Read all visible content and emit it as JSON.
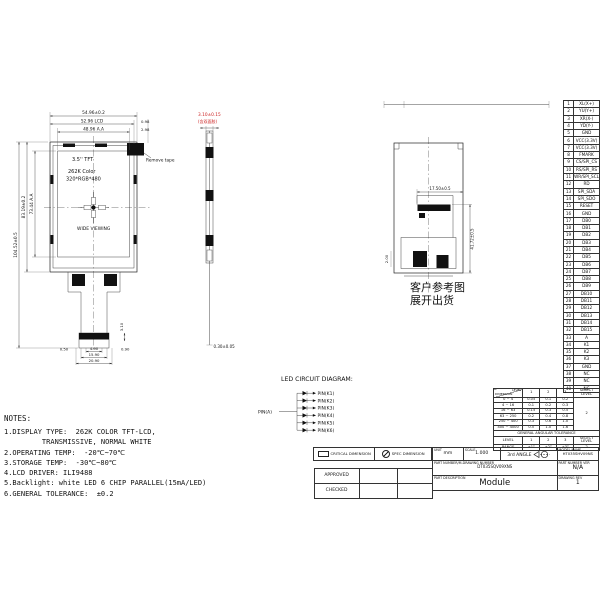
{
  "colors": {
    "line": "#222222",
    "accent_red": "#cc2222"
  },
  "front_view": {
    "panel_labels": [
      "3.5'' TFT",
      "262K Color",
      "320*RGB*480"
    ],
    "viewing_label": "WIDE VIEWING",
    "remove_tape": "Remove tape",
    "dim_width_outline": "54.96±0.2",
    "dim_width_lcd": "52.96 LCD",
    "dim_width_aa": "48.96 A.A",
    "dim_right_1": "0.98",
    "dim_right_2": "2.98",
    "dim_height_total": "104.52±0.5",
    "dim_height_outline": "83.19±0.2",
    "dim_height_aa": "73.44 A.A",
    "dim_fpc_left": "0.50",
    "dim_fpc_w1": "4.90",
    "dim_fpc_w2": "15.90",
    "dim_fpc_w3": "20.90",
    "dim_fpc_right": "0.90",
    "dim_fpc_h": "3.10"
  },
  "side_view": {
    "dim_thickness": "3.10±0.15",
    "dim_thickness_note": "(含双面胶)",
    "dim_fpc_thickness": "0.30±0.05"
  },
  "back_view": {
    "dim_connector": "17.50±0.5",
    "dim_height": "41.72±0.5",
    "dim_small": "2.00",
    "caption_line1": "客户参考图",
    "caption_line2": "展开出货"
  },
  "led_diagram": {
    "title": "LED CIRCUIT DIAGRAM:",
    "anode": "PIN(A)",
    "cathodes": [
      "PIN(K1)",
      "PIN(K2)",
      "PIN(K3)",
      "PIN(K4)",
      "PIN(K5)",
      "PIN(K6)"
    ]
  },
  "notes": {
    "title": "NOTES:",
    "lines": [
      "1.DISPLAY TYPE:  262K COLOR TFT-LCD,",
      "         TRANSMISSIVE, NORMAL WHITE",
      "2.OPERATING TEMP:  -20℃~70℃",
      "3.STORAGE TEMP:  -30℃~80℃",
      "4.LCD DRIVER: ILI9488",
      "5.Backlight: white LED 6 CHIP PARALLEL(15mA/LED)",
      "6.GENERAL TOLERANCE:  ±0.2"
    ]
  },
  "pin_table": {
    "pins": [
      {
        "no": 1,
        "name": "XL(X+)"
      },
      {
        "no": 2,
        "name": "YU(Y+)"
      },
      {
        "no": 3,
        "name": "XR(X-)"
      },
      {
        "no": 4,
        "name": "YD(Y-)"
      },
      {
        "no": 5,
        "name": "GND"
      },
      {
        "no": 6,
        "name": "VCC(3.3V)"
      },
      {
        "no": 7,
        "name": "VCC(3.3V)"
      },
      {
        "no": 8,
        "name": "FMARK"
      },
      {
        "no": 9,
        "name": "CS/SPI_CS"
      },
      {
        "no": 10,
        "name": "RS/SPI_RS"
      },
      {
        "no": 11,
        "name": "WR/SPI_SCL"
      },
      {
        "no": 12,
        "name": "RD"
      },
      {
        "no": 13,
        "name": "SPI_SDA"
      },
      {
        "no": 14,
        "name": "SPI_SDO"
      },
      {
        "no": 15,
        "name": "RESET"
      },
      {
        "no": 16,
        "name": "GND"
      },
      {
        "no": 17,
        "name": "DB0"
      },
      {
        "no": 18,
        "name": "DB1"
      },
      {
        "no": 19,
        "name": "DB2"
      },
      {
        "no": 20,
        "name": "DB3"
      },
      {
        "no": 21,
        "name": "DB4"
      },
      {
        "no": 22,
        "name": "DB5"
      },
      {
        "no": 23,
        "name": "DB6"
      },
      {
        "no": 24,
        "name": "DB7"
      },
      {
        "no": 25,
        "name": "DB8"
      },
      {
        "no": 26,
        "name": "DB9"
      },
      {
        "no": 27,
        "name": "DB10"
      },
      {
        "no": 28,
        "name": "DB11"
      },
      {
        "no": 29,
        "name": "DB12"
      },
      {
        "no": 30,
        "name": "DB13"
      },
      {
        "no": 31,
        "name": "DB14"
      },
      {
        "no": 32,
        "name": "DB15"
      },
      {
        "no": 33,
        "name": "A"
      },
      {
        "no": 34,
        "name": "K1"
      },
      {
        "no": 35,
        "name": "K2"
      },
      {
        "no": 36,
        "name": "K3"
      },
      {
        "no": 37,
        "name": "GND"
      },
      {
        "no": 38,
        "name": "NC"
      },
      {
        "no": 39,
        "name": "NC"
      },
      {
        "no": 40,
        "name": "NC"
      }
    ]
  },
  "tolerance_table": {
    "corner_top": "LEVEL",
    "corner_bottom": "DIMENSION",
    "level_headers": [
      "1",
      "2",
      "3"
    ],
    "select_label": "SELECT LEVEL",
    "select_value": "2",
    "rows": [
      {
        "range": "0 ~ 4",
        "v": [
          "0.05",
          "0.1",
          "0.2"
        ]
      },
      {
        "range": "4 ~ 16",
        "v": [
          "0.1",
          "0.2",
          "0.3"
        ]
      },
      {
        "range": "16 ~ 63",
        "v": [
          "0.15",
          "0.3",
          "0.5"
        ]
      },
      {
        "range": "63 ~ 250",
        "v": [
          "0.2",
          "0.4",
          "0.8"
        ]
      },
      {
        "range": "250 ~ 400",
        "v": [
          "0.3",
          "0.6",
          "1.0"
        ]
      },
      {
        "range": "400 ~ 4000",
        "v": [
          "0.5",
          "1.0",
          "1.6"
        ]
      }
    ],
    "angular_title": "GENERAL ANGULAR TOLERANCE",
    "angular_level_label": "LEVEL",
    "angular_range_label": "RANGE",
    "angular_levels": [
      "1",
      "2",
      "3"
    ],
    "angular_values": [
      "±1°",
      "±2°",
      "±3°"
    ],
    "angular_select_label": "SELECT LEVEL",
    "angular_select_value": "2"
  },
  "title_block": {
    "critical_dimension": "CRITICAL DIMENSION",
    "spec_dimension": "SPEC DIMENSION",
    "approved": "APPROVED",
    "checked": "CHECKED",
    "unit_label": "UNIT",
    "unit_value": "mm",
    "scale_label": "SCALE",
    "scale_value": "1.000",
    "angle_label": "3rd ANGLE",
    "model_label": "MODEL NAME",
    "model_value": "HT035SHV09NS",
    "part_number_label": "PART NUMBER/M-DRAWING NUMBER",
    "part_number_value": "DT035SQV09XNS",
    "part_ver_label": "PART NUMBER VER",
    "part_ver_value": "N/A",
    "description_label": "PART DESCRIPTION",
    "description_value": "Module",
    "rev_label": "DRAWING REV",
    "rev_value": "1"
  }
}
